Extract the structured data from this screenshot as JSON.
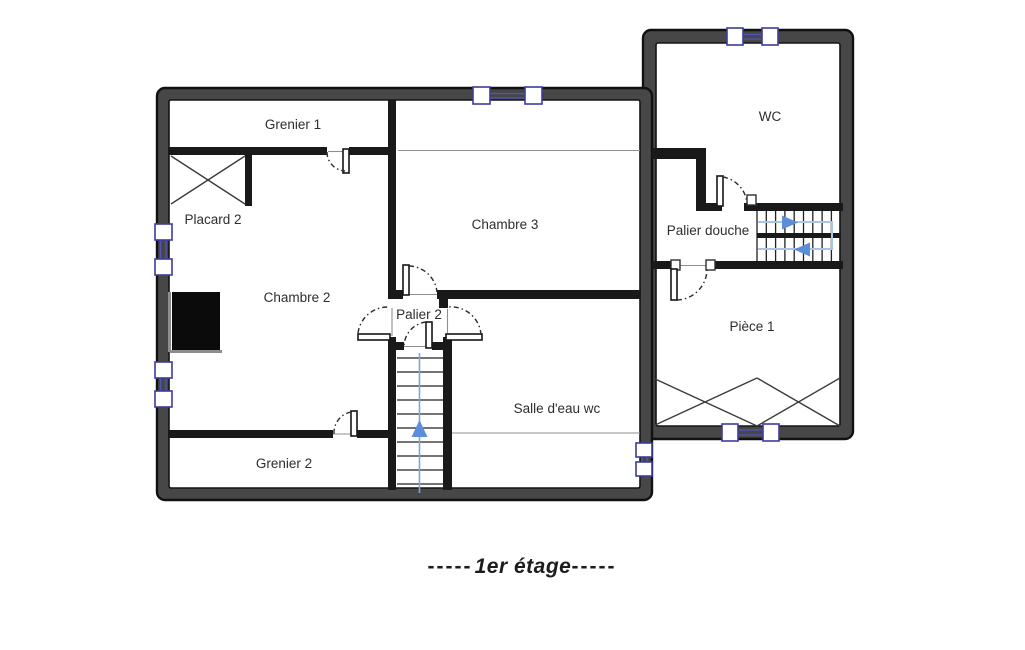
{
  "title": {
    "prefix": "-----",
    "text": "1er étage",
    "suffix": "-----"
  },
  "rooms": {
    "grenier1": "Grenier 1",
    "placard2": "Placard 2",
    "chambre2": "Chambre 2",
    "chambre3": "Chambre 3",
    "palier2": "Palier 2",
    "salle_eau": "Salle d'eau wc",
    "grenier2": "Grenier 2",
    "wc": "WC",
    "palier_douche": "Palier douche",
    "piece1": "Pièce 1"
  },
  "colors": {
    "wall_fill": "#474747",
    "wall_edge": "#111111",
    "interior_wall": "#191919",
    "window_frame": "#3c3c9e",
    "window_glass": "#5353bb",
    "stair_arrow": "#5b8dd9",
    "stair_guide": "#a9c4e7",
    "thin_line": "#8f8f8f",
    "label_text": "#2e2e2e",
    "title_text": "#1c1c1c"
  }
}
